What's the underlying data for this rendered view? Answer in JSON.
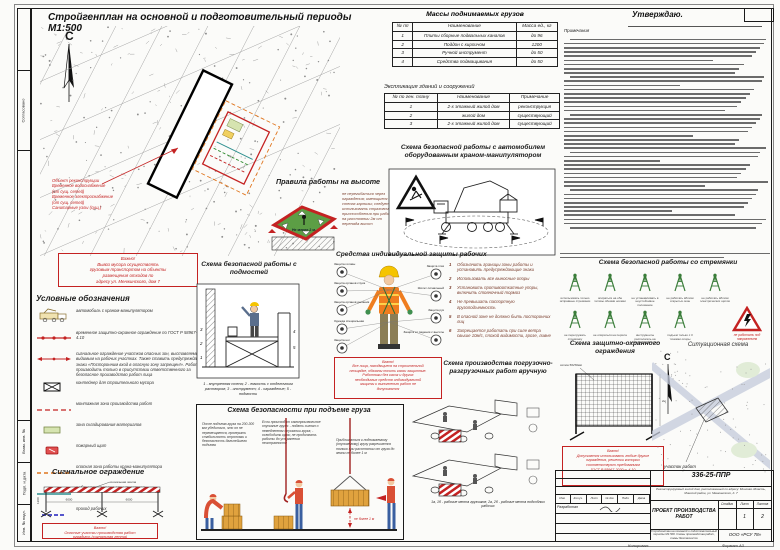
{
  "colors": {
    "accent_red": "#c42222",
    "zone_green": "#5c9e45",
    "vest_orange": "#ef7d1f",
    "teal": "#2e8f8f",
    "warn_orange": "#e0761f",
    "legend_green": "#d6e4b0"
  },
  "sheet": {
    "title": "Стройгенплан на основной и подготовительный периоды М1:500",
    "approve_label": "Утверждаю.",
    "copied_label": "Копировал:",
    "format_label": "Формат А3"
  },
  "plan": {
    "north_label": "С",
    "annotation_lines": [
      "Объект реконструкции",
      "Временное водоснабжение",
      "(от сущ. сетей)",
      "Временное электроснабжение",
      "(от сущ. сетей)",
      "Санитарные узлы (сущ.)"
    ],
    "important_lines": [
      "Важно!",
      "Вывоз мусора осуществлять",
      "грузовым транспортом на объекты",
      "размещения отходов по",
      "адресу ул. Менжинского, дом 7"
    ]
  },
  "loads_table": {
    "title": "Массы поднимаемых грузов",
    "headers": [
      "№ пп",
      "Наименование",
      "Масса ед., кг"
    ],
    "rows": [
      [
        "1",
        "Плиты сборные подвальных каналов",
        "до 96"
      ],
      [
        "2",
        "Поддон с кирпичом",
        "1200"
      ],
      [
        "3",
        "Ручной инструмент",
        "до 50"
      ],
      [
        "4",
        "Средства подмащивания",
        "до 50"
      ]
    ]
  },
  "explication_table": {
    "title": "Экспликация зданий и сооружений",
    "headers": [
      "№ по ген. плану",
      "Наименование",
      "Примечание"
    ],
    "rows": [
      [
        "1",
        "2-х этажный жилой дом",
        "реконструкция"
      ],
      [
        "2",
        "жилой дом",
        "существующий"
      ],
      [
        "3",
        "2-х этажный жилой дом",
        "существующий"
      ]
    ]
  },
  "notes": {
    "title": "Примечания",
    "line_count": 46
  },
  "legend": {
    "title": "Условные обозначения",
    "items": [
      {
        "type": "truck",
        "label": "автомобиль с краном-манипулятором"
      },
      {
        "type": "fence-line",
        "label": "временное защитно-охранное ограждение по ГОСТ Р 58967-2020 п. 4.10"
      },
      {
        "type": "signal-line",
        "label": "сигнальное ограждение участков опасных зон, выставляемое видимым на рабочих участках. Также ставить предупреждающие знаки «Посторонним вход в опасную зону запрещен!». Работы производить только в присутствии ответственного за безопасное производство работ лица"
      },
      {
        "type": "container",
        "label": "контейнер для строительного мусора"
      },
      {
        "type": "red-dash",
        "label": "монтажная зона производства работ"
      },
      {
        "type": "green-box",
        "label": "зона складирования материалов"
      },
      {
        "type": "fire-shield",
        "label": "пожарный щит"
      },
      {
        "type": "orange-dash",
        "label": "опасная зона работы крана-манипулятора"
      },
      {
        "type": "teal-line",
        "label": "рабочая зона крана-манипулятора"
      },
      {
        "type": "blue-dash",
        "label": "проход рабочих"
      }
    ]
  },
  "signal_fence": {
    "title": "Сигнальное ограждение",
    "tape_label": "сигнальная лента",
    "dims": [
      "6000",
      "6000"
    ],
    "height_dim": "1200",
    "important_lines": [
      "Важно!",
      "Опасные участки производства работ",
      "оградить (сигнальная лента)"
    ]
  },
  "height_rules": {
    "title": "Правила работы на высоте",
    "note": "не перегибаться через ограждения; имеющиеся на стенах карнизы; следует использовать страховочные приспособления при работе на расстоянии 2м от перепада высот",
    "dim_label": "Не менее 2 м."
  },
  "crane_scheme": {
    "title": "Схема безопасной работы с автомобилем оборудованным краном-манипулятором"
  },
  "ppe": {
    "title": "Средства индивидуальной защиты рабочих",
    "left_callouts": [
      "Защита головы",
      "Защита органов слуха",
      "Защита органов дыхания",
      "Одежда специальная",
      "Защита ног"
    ],
    "right_callouts": [
      "Защита глаз",
      "Жилет сигнальный",
      "Защита рук",
      "Защита от падения с высоты"
    ],
    "rules": [
      "Обозначить границы зоны работы и установить предупреждающие знаки",
      "Использовать все выносные опоры",
      "Установить противооткатные упоры, включить стояночный тормоз",
      "Не превышать паспортную грузоподъемность",
      "В опасной зоне не должно быть посторонних лиц",
      "Запрещается работать при силе ветра свыше 10м/с, плохой видимости, грозе, ливне"
    ],
    "important_lines": [
      "Важно!",
      "Все лица, находящиеся на строительной",
      "площадке, обязаны носить каски защитные.",
      "Работники без касок и других",
      "необходимых средств индивидуальной",
      "защиты к выполнению работ не",
      "допускаются"
    ]
  },
  "scaffold_scheme": {
    "title": "Схема безопасной работы с подмостей",
    "caption": "1 - внутренняя стена; 2 - емкость с отделочным раствором; 3 - инструмент; 4 - ограждение; 5 - подмости"
  },
  "manual_loading": {
    "title": "Схема производства погрузочно-разгрузочных работ вручную",
    "caption": "1а, 1б - рабочие места грузчиков; 2а, 2б - рабочие места подсобных рабочих"
  },
  "lifting": {
    "title": "Схема безопасности при подъеме груза",
    "texts": [
      "После подъема груза на 200-300 мм убедиться, что он не перемещается, проверить стабильность строповки и безопасность дальнейшего подъема",
      "Если происходит самопроизвольное опускание груза: - подать сигнал о немедленном опускании груза; - освободить крюк; не продолжать работы до устранения неисправности",
      "Приближаться к поднимаемому (опускаемому) грузу разрешается только при расстоянии от груза до земли не более 1 м"
    ],
    "dim_label": "не более 1 м"
  },
  "ladder_scheme": {
    "title": "Схема безопасной работы со стремянки",
    "captions": [
      "использовать только исправные стремянки",
      "опираться на обе тетивы обеими ногами",
      "не устанавливать в неустойчивое положение",
      "не работать вблизи открытых окон",
      "не работать вблизи электрических щитов",
      "не перегружать стремянку",
      "не опираться на перила",
      "инструменты располагать на специальной полке",
      "подъем только с 3 точками опоры"
    ],
    "warning_caption": "не работать под напряжением"
  },
  "guard_fence": {
    "title": "Схема защитно-охранного ограждения",
    "mesh_label": "сетка 50х50мм",
    "height_dim": "2м",
    "important_lines": [
      "Важно!",
      "Допускается использовать любые другие",
      "ограждения, решетки которых",
      "соответствуют требованиям",
      "ГОСТ Р 58967-2020 п. 4.10"
    ]
  },
  "situational": {
    "title": "Ситуационная схема",
    "north_label": "С",
    "site_label": "участок работ"
  },
  "stamp": {
    "doc_code": "336-25-ППР",
    "object_desc": "Реконструируемый жилой дом, расположенный по адресу: Минская область, Минский район, ул. Менжинского, д. 7",
    "doc_title": "ПРОЕКТ ПРОИЗВОДСТВА РАБОТ",
    "stage_label": "Стадия",
    "sheet_label": "Лист",
    "sheets_label": "Листов",
    "stage": "",
    "sheet": "1",
    "sheets": "2",
    "sheet_desc": "Стройгенплан на основной и подготовительный периоды М1:500. Схемы производства работ, схемы безопасности",
    "company": "ООО «РСУ 78»",
    "header_cells": [
      "Изм.",
      "Кол.уч.",
      "Лист",
      "№ док.",
      "Подп.",
      "Дата"
    ],
    "developed_label": "Разработал"
  },
  "margin": {
    "labels": [
      "Согласовано",
      "Взам. инв. №",
      "Подп. и дата",
      "Инв. № подл."
    ]
  }
}
